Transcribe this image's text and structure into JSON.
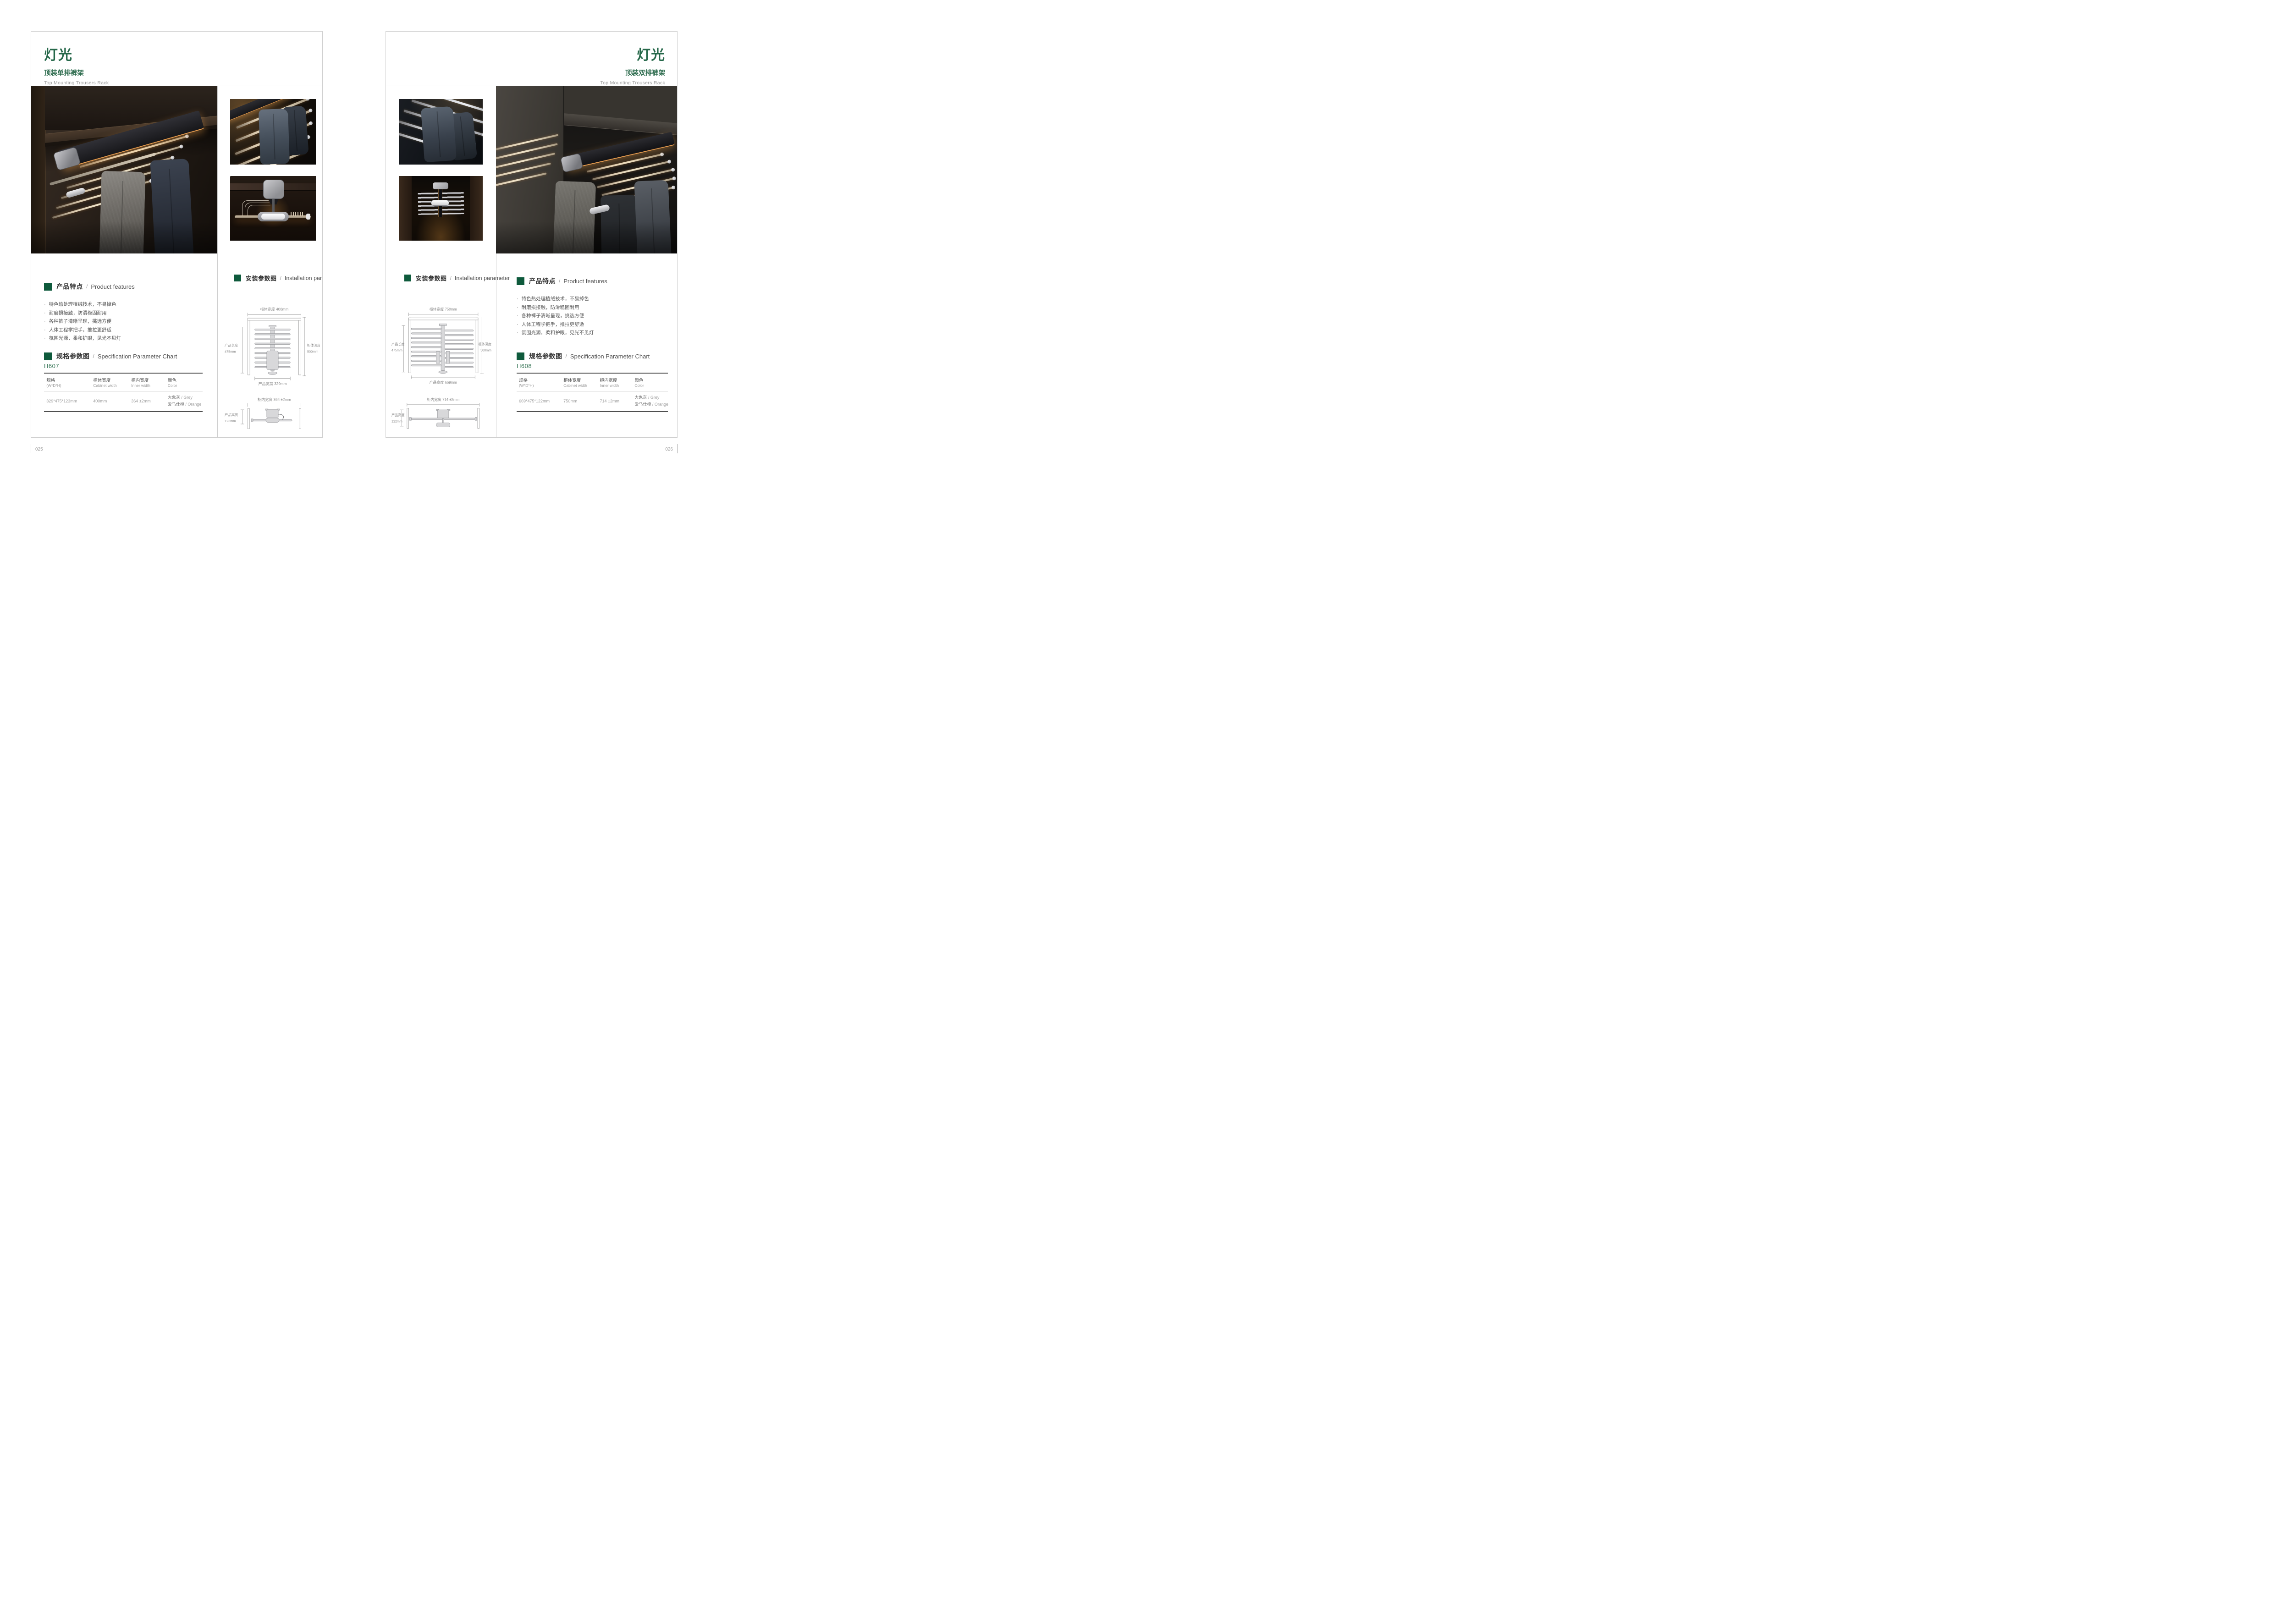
{
  "colors": {
    "accent_green": "#26684a",
    "marker_green": "#0e5a3c",
    "grey_text": "#9a9a9a",
    "amber_light": "#e8a35a"
  },
  "left_page": {
    "page_number": "025",
    "header": {
      "title": "灯光",
      "subtitle": "顶装单排裤架",
      "subtitle_en": "Top Mounting Trousers Rack"
    },
    "features": {
      "title": "产品特点",
      "sep": "/",
      "title_en": "Product features",
      "bullet": "·",
      "items": [
        "特色热处理植绒技术，不易掉色",
        "耐磨损接触，防滑稳固耐用",
        "各种裤子清晰呈现，挑选方便",
        "人体工程学把手，推拉更舒适",
        "氛围光源，柔和护眼，见光不见灯"
      ]
    },
    "spec": {
      "title": "规格参数图",
      "sep": "/",
      "title_en": "Specification Parameter Chart",
      "model": "H607",
      "columns": [
        {
          "zh": "规格",
          "en": "(W*D*H)"
        },
        {
          "zh": "柜体宽度",
          "en": "Cabinet width"
        },
        {
          "zh": "柜内宽度",
          "en": "Inner width"
        },
        {
          "zh": "颜色",
          "en": "Color"
        }
      ],
      "row": {
        "size": "329*475*123mm",
        "cabinet_width": "400mm",
        "inner_width": "364 ±2mm",
        "color1_zh": "大象灰",
        "color1_en": "/ Grey",
        "color2_zh": "爱马仕橙",
        "color2_en": "/ Orange"
      }
    },
    "install": {
      "title": "安装参数图",
      "sep": "/",
      "title_en": "Installation parameter",
      "top_diagram": {
        "top_label": "柜体宽度 400mm",
        "left_label_1": "产品长度",
        "left_label_2": "475mm",
        "right_label_1": "柜体深度",
        "right_label_2": "500mm",
        "bottom_label": "产品宽度 329mm"
      },
      "front_diagram": {
        "top_label": "柜内宽度 364 ±2mm",
        "left_label_1": "产品高度",
        "left_label_2": "123mm"
      }
    }
  },
  "right_page": {
    "page_number": "026",
    "header": {
      "title": "灯光",
      "subtitle": "顶装双排裤架",
      "subtitle_en": "Top Mounting Trousers Rack"
    },
    "features": {
      "title": "产品特点",
      "sep": "/",
      "title_en": "Product features",
      "bullet": "·",
      "items": [
        "特色热处理植绒技术，不易掉色",
        "耐磨损接触，防滑稳固耐用",
        "各种裤子清晰呈现，挑选方便",
        "人体工程学把手，推拉更舒适",
        "氛围光源，柔和护眼，见光不见灯"
      ]
    },
    "spec": {
      "title": "规格参数图",
      "sep": "/",
      "title_en": "Specification Parameter Chart",
      "model": "H608",
      "columns": [
        {
          "zh": "规格",
          "en": "(W*D*H)"
        },
        {
          "zh": "柜体宽度",
          "en": "Cabinet width"
        },
        {
          "zh": "柜内宽度",
          "en": "Inner width"
        },
        {
          "zh": "颜色",
          "en": "Color"
        }
      ],
      "row": {
        "size": "669*475*122mm",
        "cabinet_width": "750mm",
        "inner_width": "714 ±2mm",
        "color1_zh": "大象灰",
        "color1_en": "/ Grey",
        "color2_zh": "爱马仕橙",
        "color2_en": "/ Orange"
      }
    },
    "install": {
      "title": "安装参数图",
      "sep": "/",
      "title_en": "Installation parameter",
      "top_diagram": {
        "top_label": "柜体宽度 750mm",
        "left_label_1": "产品长度",
        "left_label_2": "475mm",
        "right_label_1": "柜体深度",
        "right_label_2": "500mm",
        "bottom_label": "产品宽度 669mm"
      },
      "front_diagram": {
        "top_label": "柜内宽度 714 ±2mm",
        "left_label_1": "产品高度",
        "left_label_2": "122mm"
      }
    }
  }
}
